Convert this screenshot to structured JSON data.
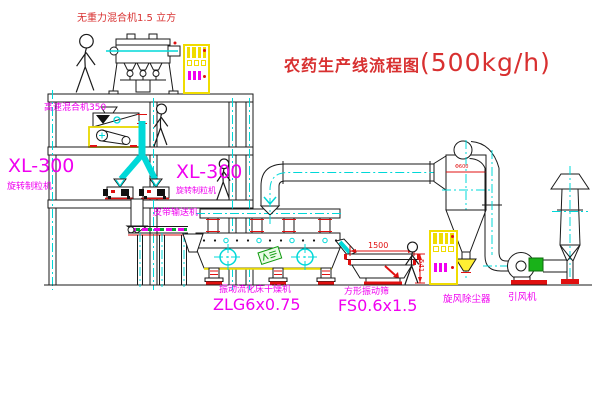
{
  "diagram": {
    "title": {
      "text": "农药生产线流程图",
      "capacity": "(500kg/h)"
    },
    "equipment_labels": {
      "gravity_mixer": "无重力混合机1.5 立方",
      "high_speed_mixer": "高速混合机350",
      "granulator_left": {
        "model": "XL-300",
        "name": "旋转制粒机"
      },
      "granulator_right": {
        "model": "XL-300",
        "name": "旋转制粒机"
      },
      "belt_conveyor": "皮带输送机",
      "fluid_bed_dryer": {
        "name": "振动流化床干燥机",
        "model": "ZLG6x0.75"
      },
      "vibrating_sieve": {
        "name": "方形振动筛",
        "model": "FS0.6x1.5"
      },
      "cyclone": "旋风除尘器",
      "induced_draft_fan": "引风机"
    },
    "dimensions": {
      "sieve_length": "1500",
      "sieve_height": "541",
      "cyclone_tag": "Φ600"
    },
    "palette": {
      "label_magenta": "#f000f0",
      "title_red": "#d83030",
      "line_black": "#1a1a1a",
      "centerline_cyan": "#00d8d8",
      "cabinet_yellow": "#f0dc00",
      "motor_green": "#19b219",
      "base_red": "#e01010"
    },
    "icons": {
      "person": "walking-figure",
      "cabinet_display": "gauge-bars",
      "circle_cross": "vibration-mount-symbol"
    }
  }
}
